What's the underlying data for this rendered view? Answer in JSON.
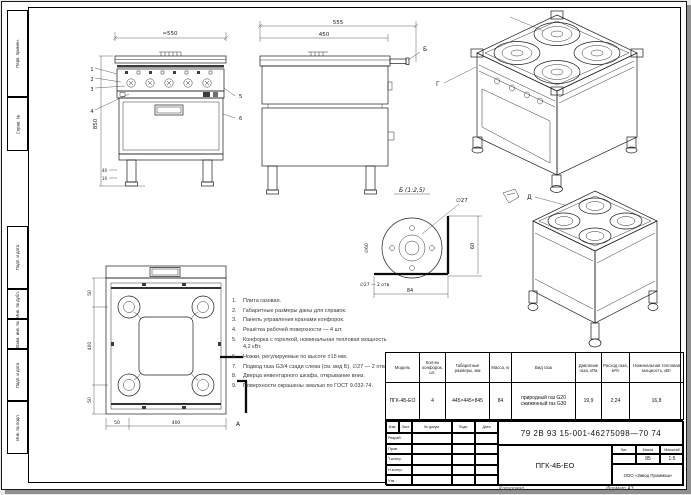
{
  "sheet": {
    "margin_labels": [
      "Перв. примен.",
      "Справ. №",
      "Подп. и дата",
      "Инв. № дубл.",
      "Взам. инв. №",
      "Подп. и дата",
      "Инв. № подл."
    ],
    "footer_copy": "Копировал",
    "footer_format": "Формат А3"
  },
  "views": {
    "front": {
      "dim_width": "≈550",
      "dim_height": "850",
      "dim_leg_a": "40",
      "dim_leg_b": "10",
      "callout_1": "1",
      "callout_2": "2",
      "callout_3": "3",
      "callout_4": "4",
      "callout_5": "5",
      "callout_6": "6"
    },
    "side": {
      "dim_width_outer": "555",
      "dim_width_inner": "450",
      "label": "Б"
    },
    "iso_top": {
      "label": "Г"
    },
    "iso_bottom": {
      "label": "Д"
    },
    "plan": {
      "dim_left_top": "50",
      "dim_left_mid": "400",
      "dim_left_bot": "50",
      "dim_bot_left": "50",
      "dim_bot_mid": "400",
      "section_label": "А"
    },
    "detail": {
      "title": "Б (1:2,5)",
      "dia_small": "∅27",
      "dia_big": "∅60",
      "dim_right": "60",
      "dim_bottom": "84",
      "note": "∅27 — 2 отв."
    }
  },
  "notes": {
    "items": [
      {
        "num": "1.",
        "text": "Плита газовая."
      },
      {
        "num": "2.",
        "text": "Габаритные размеры даны для справок."
      },
      {
        "num": "3.",
        "text": "Панель управления кранами конфорок."
      },
      {
        "num": "4.",
        "text": "Решётка рабочей поверхности — 4 шт."
      },
      {
        "num": "5.",
        "text": "Конфорка с горелкой, номинальная тепловая мощность 4,2 кВт."
      },
      {
        "num": "6.",
        "text": "Ножки, регулируемые по высоте ±15 мм."
      },
      {
        "num": "7.",
        "text": "Подвод газа G3/4 сзади слева (см. вид Б), ∅27 — 2 отв."
      },
      {
        "num": "8.",
        "text": "Дверца инвентарного шкафа, открывание вниз."
      },
      {
        "num": "9.",
        "text": "Поверхности окрашены эмалью по ГОСТ 9.032-74."
      }
    ]
  },
  "spec_table": {
    "headers": [
      "Модель",
      "Кол-во конфорок, шт.",
      "Габаритные размеры, мм",
      "Масса, кг",
      "Вид газа",
      "Давление газа, кПа",
      "Расход газа, м³/ч",
      "Номинальная тепловая мощность, кВт"
    ],
    "row": [
      "ПГК-4Б-ЕО",
      "4",
      "445×445×845",
      "84",
      "природный газ G20\nсжиженный газ G30",
      "19,9",
      "2,24",
      "16,8"
    ]
  },
  "title_block": {
    "doc_number": "79 2В 93 15-001-46275098—70 74",
    "product": "ПГК-4Б-ЕО",
    "company": "ООО «Завод Проммаш»",
    "rev_headers": [
      "Изм.",
      "Лист",
      "№ докум.",
      "Подп.",
      "Дата"
    ],
    "sign_rows": [
      "Разраб.",
      "Пров.",
      "Т.контр.",
      "Н.контр.",
      "Утв."
    ],
    "lit_headers": [
      "Лит.",
      "Масса",
      "Масштаб"
    ],
    "lit_values": [
      "",
      "85",
      "1:5"
    ]
  }
}
